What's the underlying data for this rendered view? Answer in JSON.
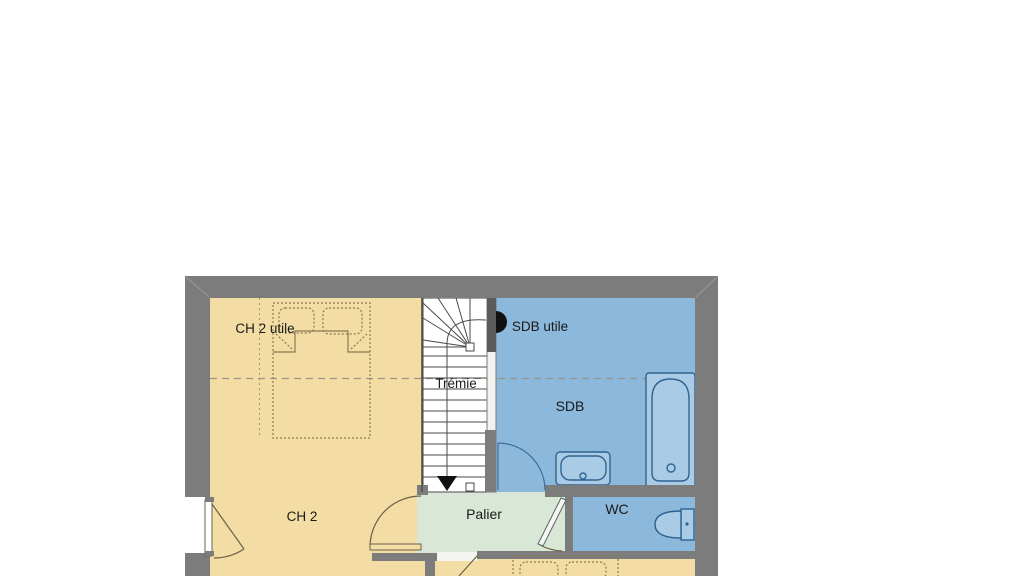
{
  "plan": {
    "title": "first-floor-plan",
    "labels": {
      "ch2_utile": "CH 2 utile",
      "tremie": "Trémie",
      "sdb_utile": "SDB utile",
      "sdb": "SDB",
      "ch2": "CH 2",
      "palier": "Palier",
      "wc": "WC"
    },
    "colors": {
      "background": "#ffffff",
      "wall": "#7c7c7c",
      "bedroom": "#f3dda4",
      "bathroom": "#8cb8db",
      "landing": "#d9e8d6",
      "stairs": "#ffffff",
      "fixture_fill": "#a9cbe5",
      "fixture_stroke": "#2f6392",
      "dashed_line": "#98948a",
      "text": "#1a1a1a"
    },
    "icons": {
      "bed": "bed-icon",
      "pillow": "pillow-icon",
      "stairs": "stairs-icon",
      "stairs_arrow": "stairs-down-arrow-icon",
      "bathtub": "bathtub-icon",
      "sink": "sink-icon",
      "toilet": "toilet-icon",
      "door": "door-swing-icon",
      "window": "window-swing-icon"
    }
  }
}
